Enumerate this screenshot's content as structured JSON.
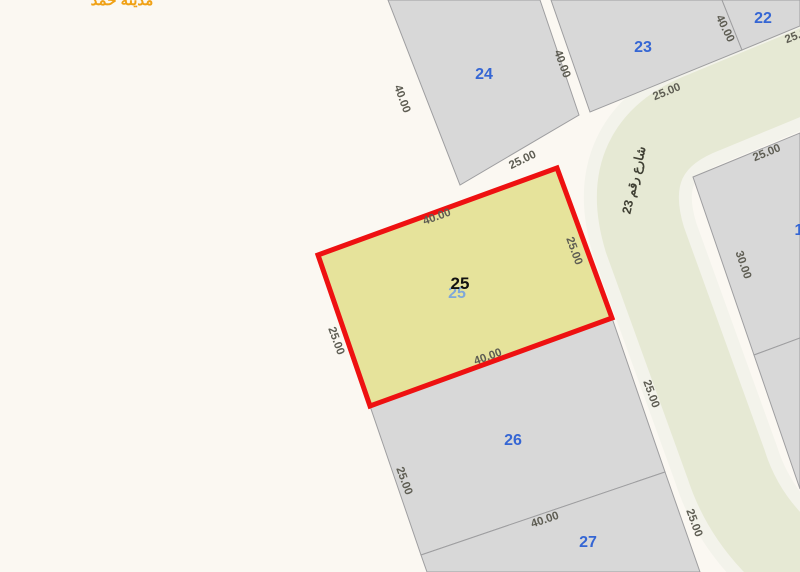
{
  "map": {
    "palette": {
      "background": "#fbf8f2",
      "plot_fill": "#d8d8d8",
      "plot_stroke": "#9e9ea0",
      "road_casing": "#f3f3eb",
      "road_surface": "#e6e9d4",
      "selected_fill": "#e6e39b",
      "selected_stroke": "#ee1111",
      "plot_number_blue": "#3566d4",
      "selected_number_black": "#111111",
      "dimension_text": "#5e5d53",
      "street_text": "#3f3f33",
      "corner_text": "#f0a115"
    },
    "road": {
      "name_label": "شارع رقم 23",
      "label_x": 638,
      "label_y": 181,
      "label_rot": -77,
      "path": "M 826,62 L 705,112 Q 616,146 645,240 L 726,464 Q 740,508 772,542 L 820,580",
      "casing_width": 108,
      "surface_width": 82
    },
    "plots": [
      {
        "id": "plot-24",
        "number": "24",
        "polygon": "388,0 540,0 579,115 460,185",
        "nx": 484,
        "ny": 79
      },
      {
        "id": "plot-23",
        "number": "23",
        "polygon": "551,0 722,0 742,50 590,112",
        "nx": 643,
        "ny": 52
      },
      {
        "id": "plot-22",
        "number": "22",
        "polygon": "722,0 800,0 800,26 742,50",
        "nx": 763,
        "ny": 23
      },
      {
        "id": "plot-right-upper",
        "number": "1",
        "polygon": "693,177 800,133 800,338 754,355",
        "nx": 799,
        "ny": 235
      },
      {
        "id": "plot-right-lower",
        "number": "",
        "polygon": "754,355 800,338 800,489",
        "nx": 0,
        "ny": 0
      },
      {
        "id": "plot-26",
        "number": "26",
        "polygon": "370,406 612,318 665,472 421,555",
        "nx": 513,
        "ny": 445
      },
      {
        "id": "plot-27",
        "number": "27",
        "polygon": "421,555 665,472 700,572 427,572",
        "nx": 588,
        "ny": 547
      }
    ],
    "selected_plot": {
      "id": "plot-25",
      "number": "25",
      "polygon": "318,255 557,168 612,318 370,406",
      "black_x": 460,
      "black_y": 289,
      "ghost_x": 457,
      "ghost_y": 298,
      "ghost_color": "#7fa8d9"
    },
    "dimensions": [
      {
        "text": "40.00",
        "x": 399,
        "y": 100,
        "rot": 70
      },
      {
        "text": "40.00",
        "x": 559,
        "y": 65,
        "rot": 70
      },
      {
        "text": "25.00",
        "x": 524,
        "y": 163,
        "rot": -26
      },
      {
        "text": "25.00",
        "x": 668,
        "y": 95,
        "rot": -22
      },
      {
        "text": "40.00",
        "x": 722,
        "y": 30,
        "rot": 64
      },
      {
        "text": "25.00",
        "x": 800,
        "y": 38,
        "rot": -22
      },
      {
        "text": "25.00",
        "x": 768,
        "y": 156,
        "rot": -22
      },
      {
        "text": "30.00",
        "x": 740,
        "y": 266,
        "rot": 71
      },
      {
        "text": "40.00",
        "x": 438,
        "y": 220,
        "rot": -20
      },
      {
        "text": "25.00",
        "x": 571,
        "y": 252,
        "rot": 70
      },
      {
        "text": "40.00",
        "x": 489,
        "y": 360,
        "rot": -20
      },
      {
        "text": "25.00",
        "x": 333,
        "y": 342,
        "rot": 70
      },
      {
        "text": "25.00",
        "x": 648,
        "y": 395,
        "rot": 70
      },
      {
        "text": "25.00",
        "x": 401,
        "y": 482,
        "rot": 70
      },
      {
        "text": "40.00",
        "x": 546,
        "y": 523,
        "rot": -19
      },
      {
        "text": "25.00",
        "x": 691,
        "y": 524,
        "rot": 70
      }
    ],
    "corner_label": {
      "text": "مدينة حمد",
      "x": 122,
      "y": 5
    }
  }
}
